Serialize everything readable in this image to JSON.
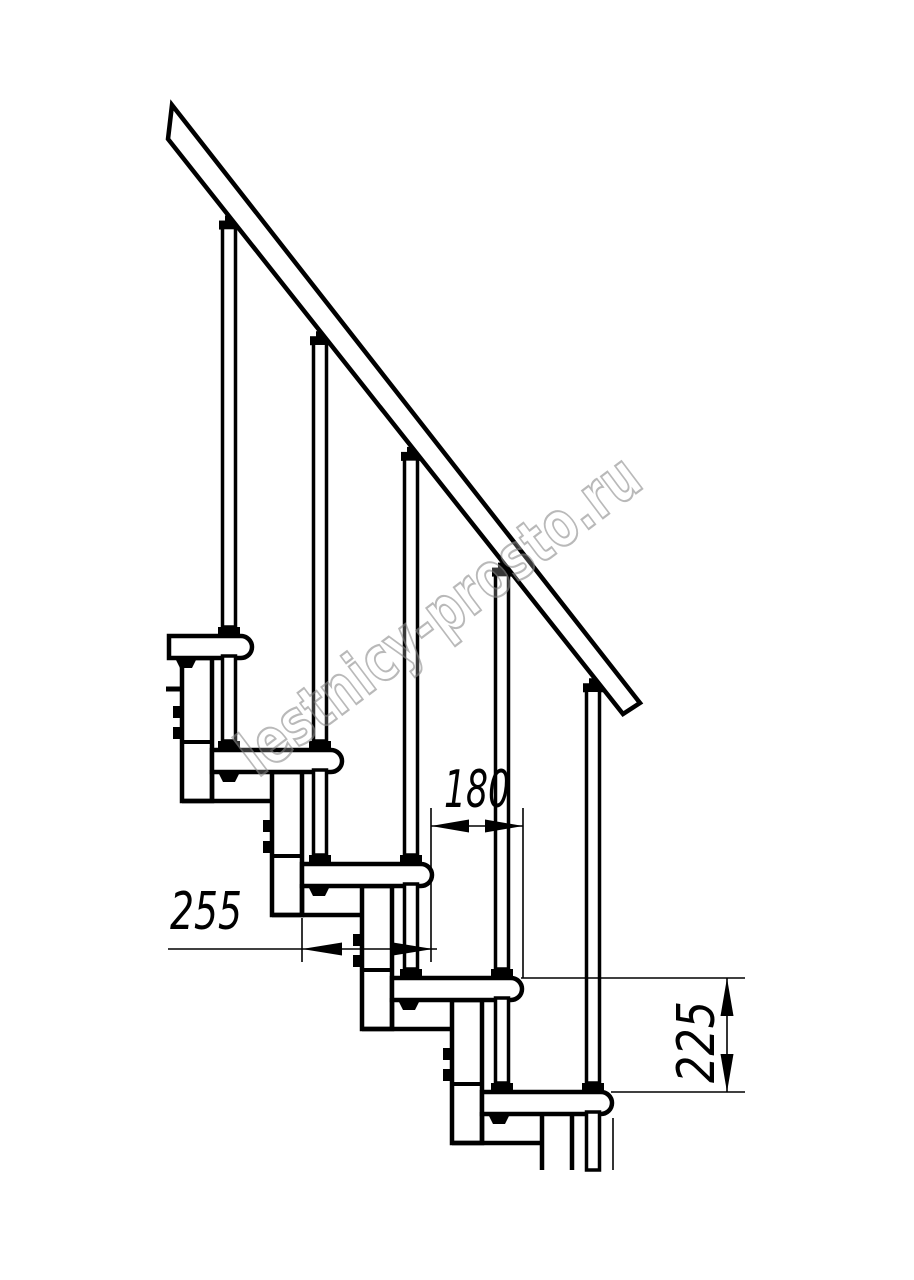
{
  "drawing": {
    "type": "modular-staircase-side-elevation",
    "watermark": {
      "text": "lestnicy-prosto.ru",
      "color": "#8f8f8f"
    },
    "dimensions": {
      "step_offset": {
        "value": "180",
        "orientation": "horizontal"
      },
      "tread_depth": {
        "value": "255",
        "orientation": "horizontal"
      },
      "riser_height": {
        "value": "225",
        "orientation": "vertical"
      }
    },
    "colors": {
      "background": "#ffffff",
      "line": "#000000"
    }
  }
}
